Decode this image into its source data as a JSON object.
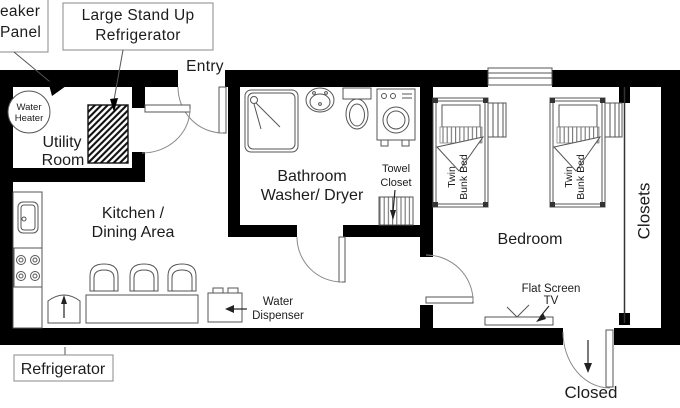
{
  "diagram_type": "apartment-floor-plan",
  "colors": {
    "wall": "#000000",
    "fixture_line": "#555555",
    "arc_line": "#8a8a8a",
    "background": "#ffffff",
    "text": "#1c1c1c"
  },
  "labels": {
    "breaker_panel": {
      "line1": "eaker",
      "line2": "Panel"
    },
    "large_fridge": {
      "line1": "Large Stand Up",
      "line2": "Refrigerator"
    },
    "entry": "Entry",
    "water_heater": {
      "line1": "Water",
      "line2": "Heater"
    },
    "utility_room": {
      "line1": "Utility",
      "line2": "Room"
    },
    "kitchen": {
      "line1": "Kitchen /",
      "line2": "Dining Area"
    },
    "bathroom": {
      "line1": "Bathroom",
      "line2": "Washer/ Dryer"
    },
    "towel_closet": {
      "line1": "Towel",
      "line2": "Closet"
    },
    "twin_bunk_bed": {
      "line1": "Twin",
      "line2": "Bunk Bed"
    },
    "bedroom": "Bedroom",
    "closets": "Closets",
    "flat_screen_tv": {
      "line1": "Flat Screen",
      "line2": "TV"
    },
    "water_dispenser": {
      "line1": "Water",
      "line2": "Dispenser"
    },
    "refrigerator": "Refrigerator",
    "closed": "Closed"
  }
}
